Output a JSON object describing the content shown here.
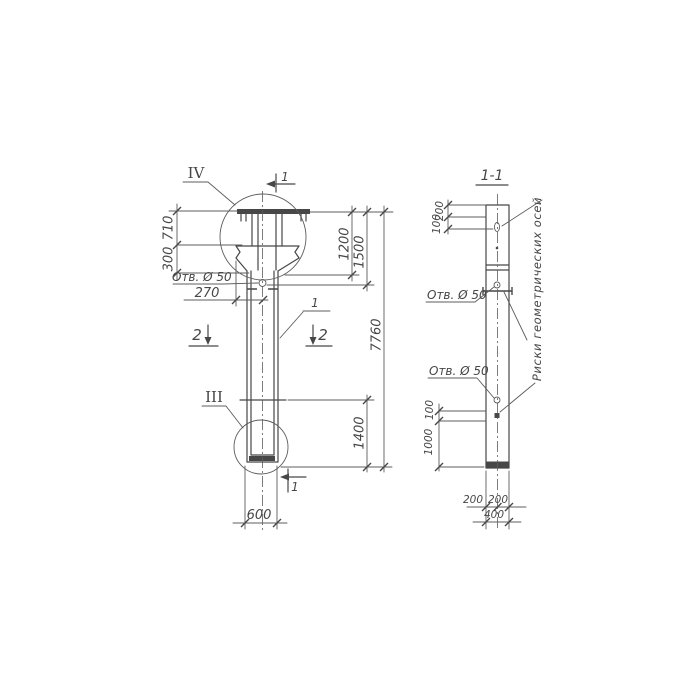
{
  "colors": {
    "paper": "#ffffff",
    "ink": "#474747",
    "ink_light": "#5c5c5c"
  },
  "elevation_view": {
    "detail_marker_top": "IV",
    "detail_marker_bottom": "III",
    "section_mark_1_top": "1",
    "section_mark_1_bottom": "1",
    "section_mark_2_left": "2",
    "section_mark_2_right": "2",
    "part_callout": "1",
    "hole_label": "Отв. Ø 50",
    "dims": {
      "d710": "710",
      "d300": "300",
      "d270": "270",
      "d1200": "1200",
      "d1500": "1500",
      "d7760": "7760",
      "d1400": "1400",
      "d600": "600"
    }
  },
  "section_view": {
    "title": "1-1",
    "hole_label_upper": "Отв. Ø 50",
    "hole_label_lower": "Отв. Ø 50",
    "axes_note": "Риски геометрических осей",
    "dims": {
      "top_200": "200",
      "top_100": "100",
      "low_100": "100",
      "low_1000": "1000",
      "bot_200_left": "200",
      "bot_200_right": "200",
      "bot_400": "400"
    }
  }
}
